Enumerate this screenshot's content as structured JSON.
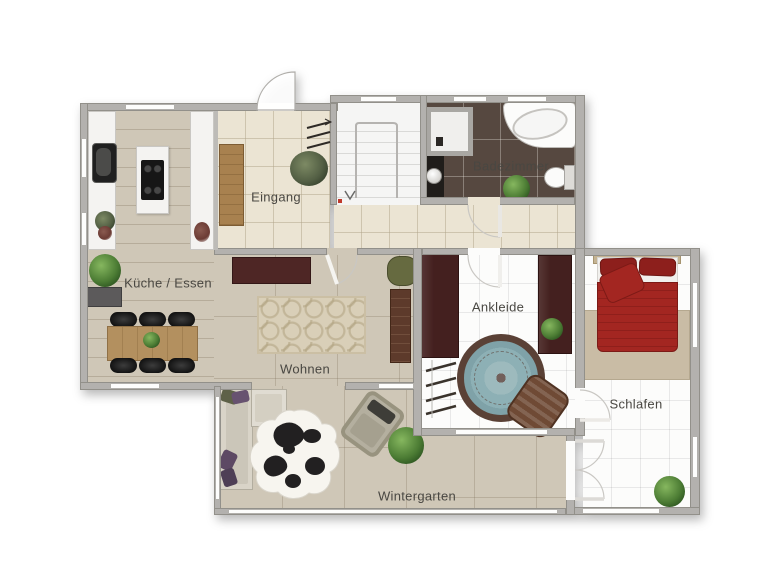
{
  "rooms": {
    "kueche": "Küche / Essen",
    "eingang": "Eingang",
    "badezimmer": "Badezimmer",
    "wohnen": "Wohnen",
    "ankleide": "Ankleide",
    "schlafen": "Schlafen",
    "wintergarten": "Wintergarten"
  },
  "colors": {
    "wall": "#b3b1ae",
    "floor_wood": "#cfc7b7",
    "floor_entry": "#ebe4d3",
    "floor_bath": "#564840",
    "floor_tile_white": "#fcfcfb",
    "wardrobe_dark": "#44201f",
    "sideboard_maroon": "#4e2625",
    "bed_red": "#a32621",
    "rug_round_teal": "#8db0b5",
    "rug_beige": "#c9bca5",
    "table_wood": "#b3905f",
    "wood_cabinet": "#a8814f",
    "sofa_light": "#d9d4c8",
    "plant_green": "#4c7c34",
    "label_text": "#494742"
  }
}
